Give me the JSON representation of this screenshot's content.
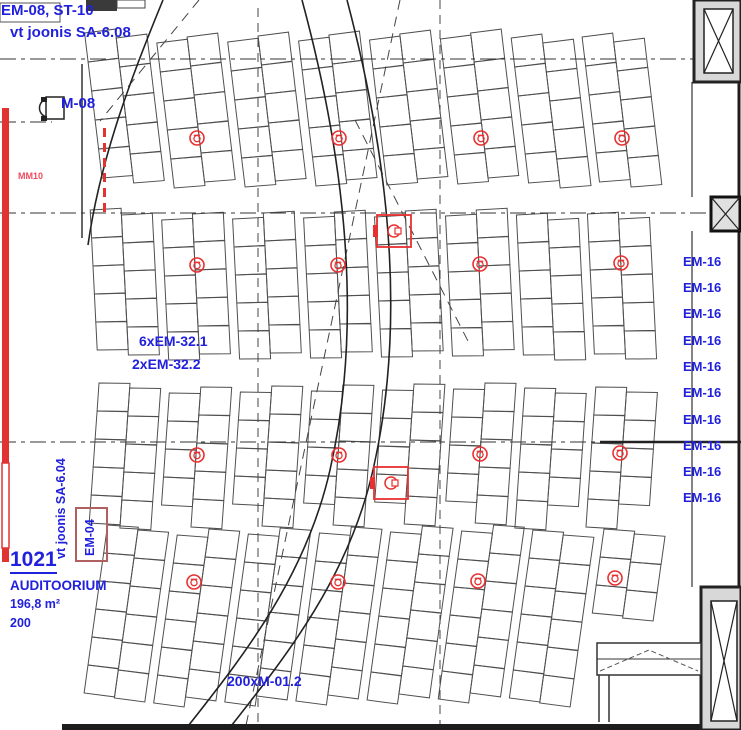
{
  "labels": {
    "em08_st10": "EM-08, ST-10",
    "vt_joonis_608": "vt joonis SA-6.08",
    "m08": "M-08",
    "mm10": "MM10",
    "em32_1": "6xEM-32.1",
    "em32_2": "2xEM-32.2",
    "room_number": "1021",
    "room_name": "AUDITOORIUM",
    "room_area": "196,8 m²",
    "room_capacity": "200",
    "m012": "200xM-01.2",
    "vt_joonis_604": "vt joonis SA-6.04",
    "em04": "EM-04"
  },
  "em16_labels": [
    "EM-16",
    "EM-16",
    "EM-16",
    "EM-16",
    "EM-16",
    "EM-16",
    "EM-16",
    "EM-16",
    "EM-16",
    "EM-16"
  ],
  "colors": {
    "blue_text": "#2020dd",
    "red_symbol": "#e83030",
    "red_bar": "#e23333",
    "mm10_red": "#ef4b5e",
    "em04_rect": "#b06060",
    "seat_line": "#4f4f4f",
    "wall_dark": "#222222",
    "dash_line": "#333333"
  },
  "diagram": {
    "seating": {
      "pairs_x": [
        94,
        165,
        236,
        307,
        378,
        449,
        520,
        591
      ],
      "col_w": 31,
      "sections": [
        {
          "y0": 38,
          "y1": 184,
          "seat_h": 29,
          "lean": 0.12
        },
        {
          "y0": 215,
          "y1": 358,
          "seat_h": 28,
          "lean": 0.05
        },
        {
          "y0": 388,
          "y1": 522,
          "seat_h": 28,
          "lean": -0.07
        },
        {
          "y0": 530,
          "y1": 714,
          "seat_h": 28,
          "lean": -0.14
        }
      ],
      "mid_y": 365,
      "row_tilt_div": 2500,
      "clip": {
        "x": 572,
        "y": 606
      }
    },
    "lines": {
      "dashdot_h": [
        [
          0,
          59,
          741
        ],
        [
          0,
          122,
          52
        ],
        [
          0,
          213,
          741
        ],
        [
          0,
          442,
          741
        ]
      ],
      "solid_h": [
        [
          600,
          442,
          741,
          2.5
        ]
      ],
      "dashed_v": [
        [
          258,
          8,
          726
        ],
        [
          440,
          0,
          726
        ]
      ],
      "dashed_diag": [
        [
          199,
          0,
          100,
          121
        ],
        [
          400,
          0,
          245,
          730
        ],
        [
          355,
          120,
          470,
          345
        ]
      ],
      "curves": [
        "M302,0 C348,170 362,330 330,470 C305,580 240,660 185,730",
        "M347,0 C392,170 405,330 373,470 C348,580 283,660 228,730",
        "M163,0 C130,80 100,160 88,245"
      ],
      "black_v": [
        [
          82,
          64,
          238,
          1.5
        ],
        [
          692,
          82,
          197,
          1.2
        ],
        [
          692,
          231,
          587,
          1.2
        ]
      ],
      "right_wall": [
        739,
        0,
        730,
        3
      ],
      "bottom_wall": [
        62,
        727,
        741,
        6
      ]
    },
    "walls": {
      "top_right_col": {
        "outer": [
          694,
          0,
          47,
          82
        ],
        "inner": [
          704,
          9,
          29,
          64
        ]
      },
      "right_x_box": {
        "rect": [
          711,
          197,
          29,
          34
        ]
      },
      "bottom_right_col": {
        "outer": [
          701,
          587,
          40,
          143
        ],
        "inner": [
          711,
          601,
          26,
          120
        ]
      },
      "door_band": {
        "rect": [
          597,
          643,
          104,
          32
        ],
        "mid_y": 659,
        "chevron": [
          [
            600,
            671
          ],
          [
            649,
            650
          ],
          [
            698,
            671
          ]
        ],
        "stems": [
          [
            599,
            675,
            722
          ],
          [
            609,
            675,
            722
          ]
        ]
      },
      "top_left": {
        "dark_rect": [
          86,
          0,
          31,
          11
        ],
        "outline_rect": [
          117,
          0,
          28,
          8
        ],
        "em08_box": [
          0,
          3,
          60,
          19
        ]
      }
    },
    "red": {
      "bar": {
        "x": 2,
        "w": 7,
        "solid1": [
          108,
          463
        ],
        "outline": [
          463,
          548
        ],
        "solid2": [
          548,
          562
        ]
      },
      "dash_v": [
        104.5,
        128,
        213
      ],
      "outlets": [
        [
          197,
          138
        ],
        [
          339,
          138
        ],
        [
          481,
          138
        ],
        [
          622,
          138
        ],
        [
          197,
          265
        ],
        [
          338,
          265
        ],
        [
          480,
          264
        ],
        [
          621,
          263
        ],
        [
          197,
          455
        ],
        [
          339,
          455
        ],
        [
          480,
          454
        ],
        [
          620,
          453
        ],
        [
          194,
          582
        ],
        [
          338,
          582
        ],
        [
          478,
          581
        ],
        [
          615,
          578
        ]
      ],
      "floor_boxes": [
        [
          394,
          231
        ],
        [
          391,
          483
        ]
      ],
      "em04_rect": [
        76,
        508,
        31,
        53
      ]
    },
    "device_m08": {
      "rect": [
        46,
        97,
        18,
        22
      ],
      "feet": [
        [
          41,
          97,
          6,
          5
        ],
        [
          41,
          116,
          6,
          5
        ]
      ]
    }
  }
}
